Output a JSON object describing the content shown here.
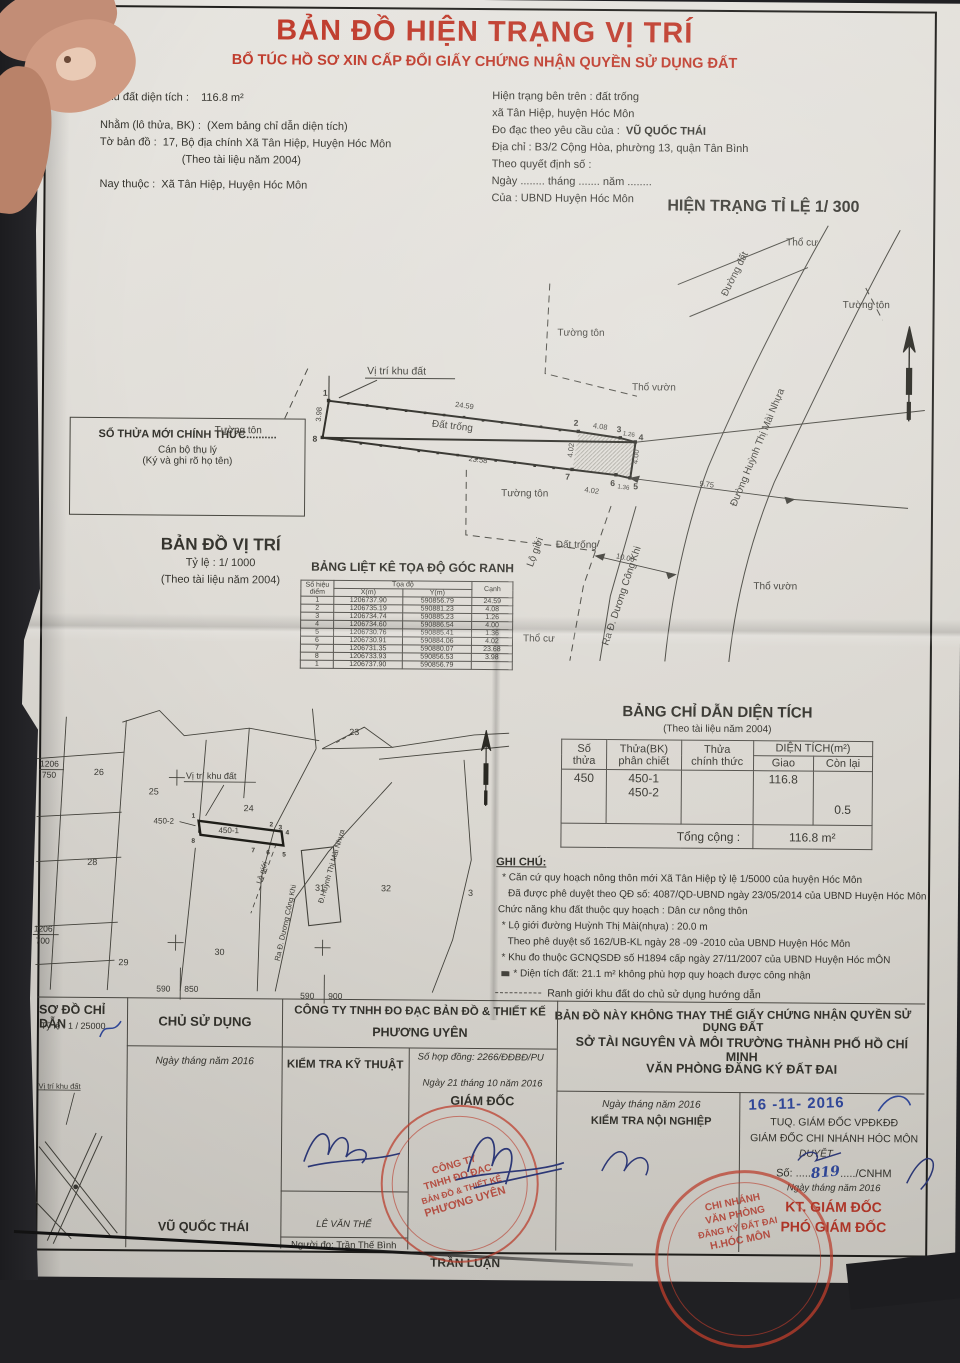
{
  "title_block": {
    "title": "BẢN ĐỒ HIỆN TRẠNG VỊ TRÍ",
    "subtitle": "BỔ TÚC HỒ SƠ XIN CẤP ĐỔI GIẤY CHỨNG NHẬN QUYỀN SỬ DỤNG ĐẤT"
  },
  "info_left": {
    "area_label": "Khu đất diện tích :",
    "area_value": "116.8 m²",
    "parcel_label": "Nhằm (lô thửa, BK) :",
    "parcel_value": "(Xem bảng chỉ dẫn diện tích)",
    "sheet_label": "Tờ bản đồ :",
    "sheet_value": "17, Bộ địa chính Xã Tân Hiệp, Huyện Hóc Môn",
    "sheet_note": "(Theo tài liệu năm 2004)",
    "now_label": "Nay thuộc :",
    "now_value": "Xã Tân Hiệp, Huyện Hóc Môn"
  },
  "info_right": {
    "line1": "Hiện trạng bên trên : đất trống",
    "line2": "xã Tân Hiệp, huyện Hóc Môn",
    "line3_label": "Đo đạc theo yêu cầu của :",
    "line3_value": "VŨ QUỐC THÁI",
    "line4": "Địa chỉ : B3/2 Cộng Hòa, phường 13, quận Tân Bình",
    "line5": "Theo quyết định số :",
    "line6": "Ngày ........ tháng ....... năm ........",
    "line7": "Của : UBND Huyện Hóc Môn"
  },
  "main_map": {
    "scale_title": "HIỆN TRẠNG TỈ LỆ 1/ 300",
    "labels": {
      "tho_cu_top": "Thổ cư",
      "duong_dat": "Đường đất",
      "tuong_ton_1": "Tường tôn",
      "tuong_ton_2": "Tường tôn",
      "tuong_ton_3": "Tường tôn",
      "tuong_ton_4": "Tường tôn",
      "vi_tri": "Vị trí khu đất",
      "tho_vuon_1": "Thổ vườn",
      "tho_vuon_2": "Thổ vườn",
      "dat_trong_1": "Đất trống",
      "dat_trong_2": "Đất trống",
      "tho_cu_bottom": "Thổ cư",
      "lo_gioi": "Lộ giới",
      "road_main": "Đường Huỳnh Thị Mài Nhựa",
      "road_out": "Ra Đ. Dương Công Khi"
    },
    "dims": {
      "d12": "24.59",
      "d23": "4.08",
      "d34": "1.26",
      "d27": "4.02",
      "d45": "4.00",
      "d56": "1.36",
      "d67": "4.02",
      "d87": "23.58",
      "d81": "3.98",
      "d_road": "9.75",
      "d_lo": "10.00"
    },
    "points": [
      "1",
      "2",
      "3",
      "4",
      "5",
      "6",
      "7",
      "8"
    ]
  },
  "official_box": {
    "line1": "SỐ THỬA MỚI CHÍNH THỨC..........",
    "line2": "Cán bộ thụ lý",
    "line3": "(Ký và ghi rõ họ tên)"
  },
  "vi_tri_map": {
    "title": "BẢN ĐỒ VỊ TRÍ",
    "scale": "Tỷ lệ : 1/ 1000",
    "note": "(Theo tài liệu năm 2004)",
    "plots": {
      "p26": "26",
      "p25": "25",
      "p28": "28",
      "p29": "29",
      "p30": "30",
      "p23": "23",
      "p24": "24",
      "p31": "31",
      "p32": "32",
      "p3": "3",
      "p450_1": "450-1",
      "p450_2": "450-2"
    },
    "labels": {
      "vi_tri": "Vị trí khu đất",
      "lo_gioi": "Lộ giới",
      "road_main": "Đ.Huỳnh Thị Mài Nhựa",
      "road_out": "Ra Đ. Dương Công Khi",
      "g1a": "1206",
      "g1b": "750",
      "g2a": "1206",
      "g2b": "700",
      "g3a": "590",
      "g3b": "850",
      "g4a": "590",
      "g4b": "900"
    }
  },
  "coord_table": {
    "title": "BẢNG LIỆT KÊ TỌA ĐỘ GÓC RANH",
    "h_point": "Số hiệu",
    "h_point2": "điểm",
    "h_coord": "Tọa độ",
    "h_x": "X(m)",
    "h_y": "Y(m)",
    "h_edge": "Cạnh",
    "rows": [
      [
        "1",
        "1206737.90",
        "590856.79",
        "24.59"
      ],
      [
        "2",
        "1206735.19",
        "590881.23",
        "4.08"
      ],
      [
        "3",
        "1206734.74",
        "590885.23",
        "1.26"
      ],
      [
        "4",
        "1206734.60",
        "590886.54",
        "4.00"
      ],
      [
        "5",
        "1206730.76",
        "590885.41",
        "1.36"
      ],
      [
        "6",
        "1206730.91",
        "590884.06",
        "4.02"
      ],
      [
        "7",
        "1206731.35",
        "590880.07",
        "23.68"
      ],
      [
        "8",
        "1206733.93",
        "590856.53",
        "3.98"
      ],
      [
        "1",
        "1206737.90",
        "590856.79",
        ""
      ]
    ]
  },
  "area_table": {
    "title": "BẢNG CHỈ DẪN DIỆN TÍCH",
    "note": "(Theo tài liệu năm 2004)",
    "h_so_1": "Số",
    "h_so_2": "thửa",
    "h_bk_1": "Thửa(BK)",
    "h_bk_2": "phân chiết",
    "h_ct_1": "Thửa",
    "h_ct_2": "chính thức",
    "h_dt": "DIỆN TÍCH(m²)",
    "h_giao": "Giao",
    "h_conlai": "Còn lại",
    "r_so_thua": "450",
    "r_bk_1": "450-1",
    "r_bk_2": "450-2",
    "r_ct": "",
    "r_giao": "116.8",
    "r_conlai": "0.5",
    "total_label": "Tổng cộng :",
    "total_value": "116.8 m²"
  },
  "ghi_chu": {
    "heading": "GHI CHÚ:",
    "l1": "* Căn cứ quy hoạch nông thôn mới Xã Tân Hiệp tỷ lệ 1/5000 của huyện Hóc Môn",
    "l2": "Đã được phê duyệt theo QĐ số: 4087/QD-UBND ngày 23/05/2014 của UBND Huyện Hóc Môn",
    "l3": "Chức năng khu đất thuộc quy hoạch :  Dân cư nông thôn",
    "l4": "* Lộ giới đường Huỳnh Thị Mài(nhựa) :  20.0 m",
    "l5": "Theo phê duyệt số 162/UB-KL  ngày 28 -09 -2010 của UBND Huyện Hóc Môn",
    "l6": "* Khu đo thuộc GCNQSDĐ số  H1894 cấp ngày 27/11/2007 của UBND Huyện Hóc mÔN",
    "l7": "* Diện tích đất: 21.1 m² không phù hợp quy hoạch  được công nhận",
    "l8": "Ranh giới khu đất do chủ sử dụng hướng dẫn",
    "l9": "BẢN ĐỒ NÀY KHÔNG THAY THẾ GIẤY CHỨNG NHẬN QUYỀN SỬ DỤNG ĐẤT"
  },
  "footer": {
    "sketch_title": "SƠ ĐỒ CHỈ DẪN",
    "sketch_scale": "Tỷ lệ :  1 / 25000",
    "sketch_label": "Vị trí khu đất",
    "owner_header": "CHỦ SỬ DỤNG",
    "owner_date": "Ngày    tháng    năm 2016",
    "owner_name": "VŨ QUỐC THÁI",
    "company_line1": "CÔNG TY TNHH ĐO ĐẠC BẢN ĐỒ & THIẾT KẾ",
    "company_line2": "PHƯƠNG UYÊN",
    "contract": "Số hợp đồng: 2266/ĐĐBĐ/PU",
    "tech_check": "KIỂM TRA KỸ THUẬT",
    "tech_name": "LÊ VĂN THẾ",
    "measurer": "Người đo: Trần Thế Bình",
    "director_date": "Ngày 21 tháng 10 năm 2016",
    "director_title": "GIÁM ĐỐC",
    "dept_line1": "SỞ TÀI NGUYÊN VÀ MÔI TRƯỜNG THÀNH PHỐ HỒ CHÍ MINH",
    "dept_line2": "VĂN PHÒNG ĐĂNG KÝ ĐẤT ĐAI",
    "internal_date": "Ngày    tháng    năm 2016",
    "internal_check": "KIỂM TRA NỘI NGHIỆP",
    "internal_name": "TRẦN LUẬN",
    "date_stamp": "16 -11- 2016",
    "approve_line1": "TUQ. GIÁM ĐỐC VPĐKĐĐ",
    "approve_line2": "GIÁM ĐỐC CHI NHÁNH HÓC MÔN",
    "approve_duyet": "DUYỆT",
    "approve_so_label": "Số: .....",
    "approve_so_value": "819",
    "approve_so_suffix": "...../CNHM",
    "approve_date": "Ngày     tháng     năm 2016",
    "kt_giam_doc": "KT. GIÁM ĐỐC",
    "pho_giam_doc": "PHÓ GIÁM ĐỐC"
  },
  "stamps": {
    "company_stamp": {
      "l1": "CÔNG TY",
      "l2": "TNHH ĐO ĐẠC",
      "l3": "BẢN ĐỒ & THIẾT KẾ",
      "l4": "PHƯƠNG UYÊN"
    },
    "office_stamp": {
      "l1": "CHI NHÁNH",
      "l2": "VĂN PHÒNG",
      "l3": "ĐĂNG KÝ ĐẤT ĐAI",
      "l4": "H.HÓC MÔN"
    }
  },
  "colors": {
    "title_red": "#bf3a2b",
    "stamp_red": "#c53e2d",
    "ink_blue": "#31499e",
    "paper": "#dedbd5"
  }
}
